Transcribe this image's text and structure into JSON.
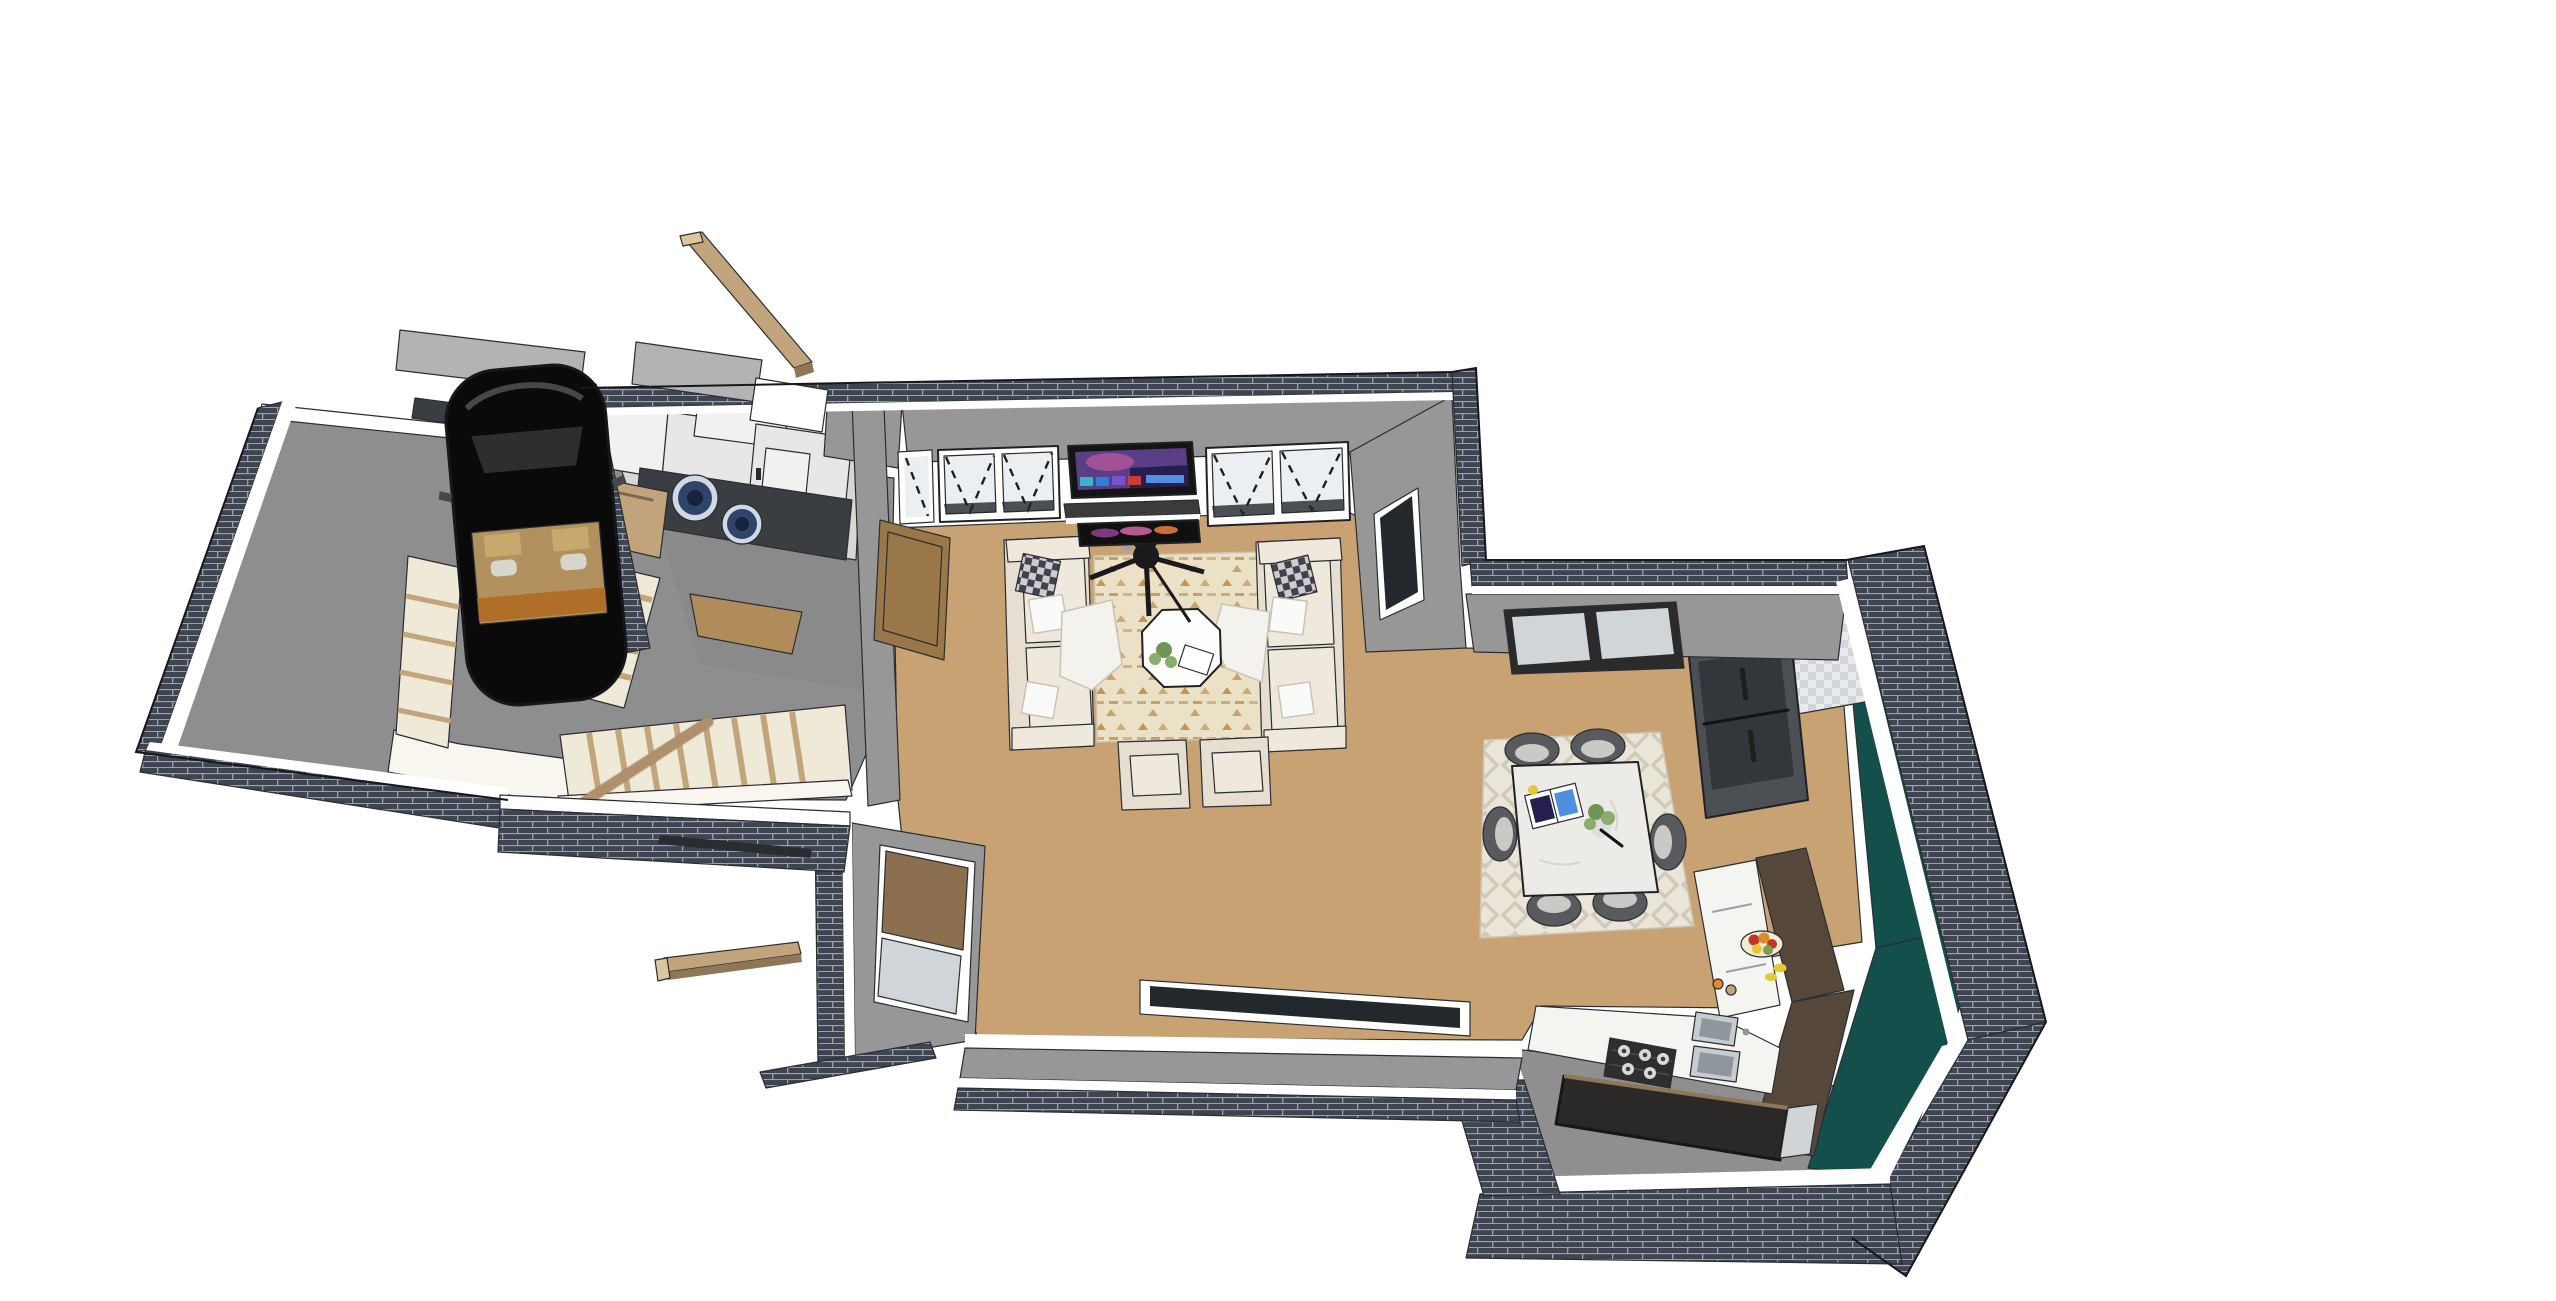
{
  "canvas": {
    "width": 2556,
    "height": 1301
  },
  "scene": {
    "render_style": "sketchup-cutaway-floorplan",
    "objects": [
      "driveway",
      "garage",
      "black-car",
      "staircase",
      "stair-handrail",
      "laundry-room",
      "washer",
      "dryer",
      "white-cabinets",
      "wood-door",
      "living-room",
      "sofa-left",
      "sofa-right",
      "armchair",
      "throw-pillow",
      "plaid-pillow",
      "blanket",
      "area-rug-living",
      "octagon-coffee-table",
      "ceiling-fan",
      "tv-screen",
      "media-shelf",
      "electric-fireplace",
      "casement-window",
      "roller-blind-window",
      "low-wall-window",
      "dining-area",
      "area-rug-dining",
      "marble-dining-table",
      "dining-chair",
      "open-magazine",
      "glass-vase-plant",
      "kitchen",
      "refrigerator",
      "wall-oven",
      "checker-backsplash",
      "counter-white",
      "gas-cooktop",
      "double-sink",
      "kitchen-island",
      "tall-cabinets-brown",
      "teal-feature-wall",
      "fruit-bowl",
      "spice-jars",
      "brick-wall-cutaway",
      "wood-roof-beam"
    ]
  },
  "colors": {
    "background": "#ffffff",
    "brick": "#3e4450",
    "brick_mortar": "#9aa1ae",
    "wall_white": "#ffffff",
    "wall_grey": "#979797",
    "wall_grey2": "#858585",
    "parapet": "#b3b3b3",
    "concrete": "#8e8e8e",
    "concrete2": "#a3a3a3",
    "wood_floor": "#c9a273",
    "wood_hall": "#b08c5a",
    "beam_top": "#c2a47c",
    "beam_side": "#8f7656",
    "beam_end": "#dcc69c",
    "stair_base": "#efe9d7",
    "stair_nose": "#c3a57b",
    "stair_white": "#f8f6ef",
    "stair_wood": "#b99a6b",
    "rail": "#bfa178",
    "door_sweep": "#2a2d30",
    "sofa": "#e6dfd1",
    "cushion": "#efe9dd",
    "pillow_white": "#fafaf8",
    "plaid_dark": "#42424c",
    "plaid_mid": "#a7a5b0",
    "blanket": "#f4f2ec",
    "rug_living": "#ebe1c6",
    "rug_living_pat": "#b98a43",
    "rug_dining": "#eae5d9",
    "rug_dining_pat": "#d2cab8",
    "marble": "#ecebe7",
    "chair_dark": "#585a5e",
    "chair_line": "#3a3c40",
    "chair_seat": "#c9c9c6",
    "fan_black": "#1a1a1a",
    "hub_grey": "#9aa2a8",
    "tv_frame": "#141414",
    "tv_screen": "#5a3f86",
    "tv_pink": "#b4569a",
    "tv_sky": "#241f4e",
    "app_green": "#36b6c8",
    "app_blue": "#2f7fd4",
    "app_purple": "#7b52c9",
    "app_red": "#cf3b33",
    "app_bar": "#4f8fe0",
    "shelf_dark": "#3b3b3b",
    "fire_black": "#101010",
    "flame_purple": "#8a3f8a",
    "flame_pink": "#c7639e",
    "flame_orange": "#e07a3a",
    "glass": "#eceff1",
    "glass_grey": "#cfd5d8",
    "glass_dark": "#23282c",
    "frame_dark": "#2b2b2b",
    "teal_wall": "#14504b",
    "teal_dark": "#0c3835",
    "cabinet_brown": "#55483a",
    "island_dark": "#2b2927",
    "island_cap": "#d0d4d7",
    "counter_white": "#f4f4f1",
    "cooktop_black": "#2e2e2e",
    "burner_ring": "#d9d9d9",
    "burner_center": "#3a3a3a",
    "sink_grey": "#c7ccd1",
    "sink_dark": "#8f969c",
    "fridge_grey": "#4b5055",
    "fridge_door": "#33373b",
    "appliance_black": "#1c1e20",
    "backsplash": "#e9ebed",
    "backsplash_chk": "#d2d6da",
    "laundry_counter": "#3a3d42",
    "washer_ring": "#cfd8e4",
    "washer_glass": "#2f4468",
    "washer_center": "#16233c",
    "cabinet_white": "#f1f1ef",
    "cabinet_white2": "#e7e7e5",
    "floor_laundry": "#d9d7d1",
    "door_brown": "#9a7748",
    "door_brown_dark": "#6e5433",
    "blind_brown": "#8b6f4e",
    "car_black": "#0a0a0b",
    "car_glass": "#2e2e31",
    "car_interior": "#b2915f",
    "car_dash": "#b06f28",
    "car_seat": "#d8d5cd",
    "car_seatback": "#c7a96e",
    "car_highlight": "#47474b",
    "bowl_cream": "#f3ead2",
    "fruit_red": "#c4342c",
    "fruit_orange": "#e08a28",
    "fruit_yellow": "#e6c832",
    "fruit_green": "#7da04f",
    "plant_green": "#6f9556",
    "plant_green2": "#8aac6d",
    "kitchen_floor": "#8f8f8f",
    "page_white": "#fdfdfb"
  }
}
